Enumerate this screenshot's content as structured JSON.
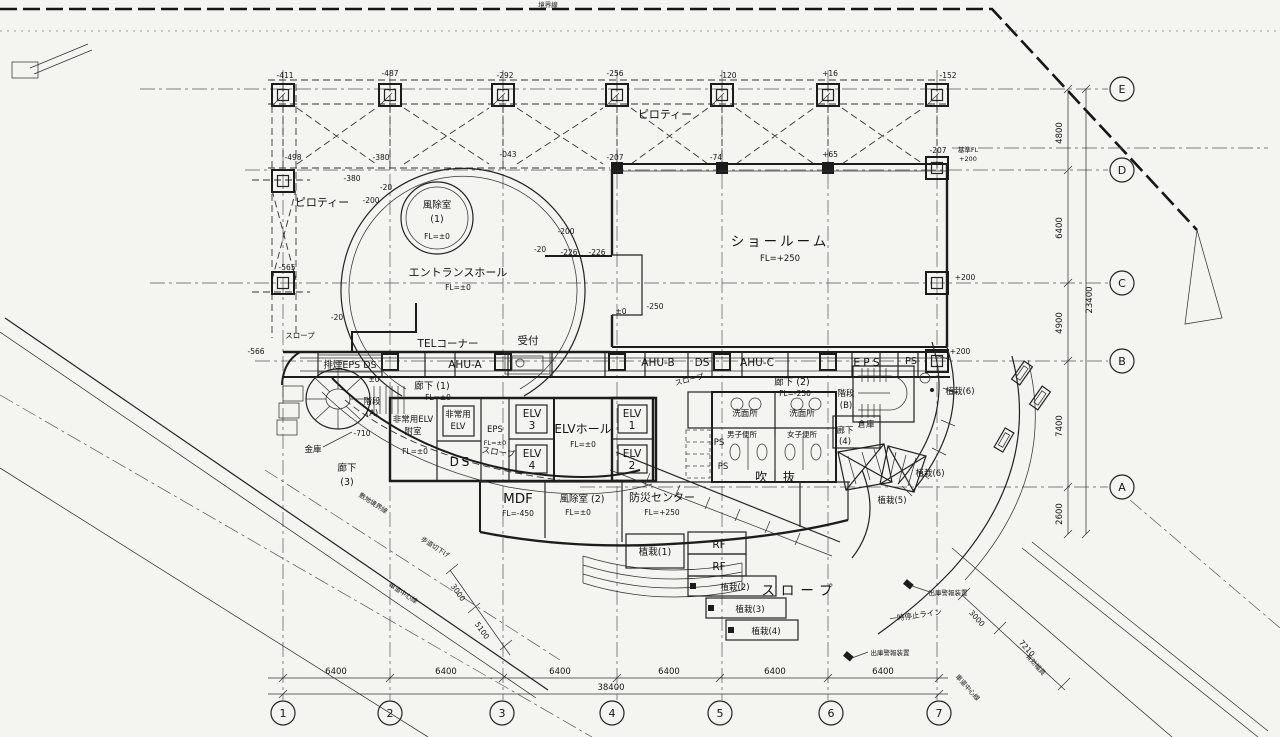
{
  "palette": {
    "paper": "#f4f4f0",
    "ink": "#1c1c1c"
  },
  "grid": {
    "rows": [
      {
        "label": "E"
      },
      {
        "label": "D"
      },
      {
        "label": "C"
      },
      {
        "label": "B"
      },
      {
        "label": "A"
      }
    ],
    "cols": [
      {
        "label": "1"
      },
      {
        "label": "2"
      },
      {
        "label": "3"
      },
      {
        "label": "4"
      },
      {
        "label": "5"
      },
      {
        "label": "6"
      },
      {
        "label": "7"
      }
    ],
    "row_dims": [
      "4800",
      "6400",
      "4900",
      "7400",
      "2600"
    ],
    "row_total": "23400",
    "col_dims": [
      "6400",
      "6400",
      "6400",
      "6400",
      "6400",
      "6400"
    ],
    "col_total": "38400"
  },
  "rooms": {
    "pilotis_left": "ピロティー",
    "pilotis_top": "ピロティー",
    "windbreak1": "風除室",
    "windbreak1_no": "(1)",
    "windbreak1_fl": "FL=±0",
    "entrance_hall": "エントランスホール",
    "entrance_hall_fl": "FL=±0",
    "showroom": "ショールーム",
    "showroom_fl": "FL=+250",
    "tel_corner": "TELコーナー",
    "reception": "受付",
    "ahu_a": "AHU-A",
    "ahu_b": "AHU-B",
    "ahu_c": "AHU-C",
    "ds_band": "DS",
    "eps_band": "EPS",
    "ps_band": "PS",
    "shaft_box": "排煙EPS DS",
    "corridor1": "廊下 (1)",
    "corridor1_fl": "FL=±0",
    "corridor2": "廊下 (2)",
    "corridor2_fl": "FL=-250",
    "corridor3_a": "廊下",
    "corridor3_b": "(3)",
    "corridor4_a": "廊下",
    "corridor4_b": "(4)",
    "stair_a": "階段",
    "stair_a_no": "(A)",
    "stair_b": "階段",
    "stair_b_no": "(B)",
    "em_lobby_1": "非常用ELV",
    "em_lobby_2": "附室",
    "em_lobby_fl": "FL=±0",
    "em_elv_1": "非常用",
    "em_elv_2": "ELV",
    "eps_core": "EPS",
    "eps_core_fl": "FL=±0",
    "ds_core": "DS",
    "elv": "ELV",
    "elv1_no": "1",
    "elv2_no": "2",
    "elv3_no": "3",
    "elv4_no": "4",
    "elv_hall": "ELVホール",
    "elv_hall_fl": "FL=±0",
    "washroom1": "洗面所",
    "washroom2": "洗面所",
    "mens_wc": "男子便所",
    "womens_wc": "女子便所",
    "ps_1": "PS",
    "ps_2": "PS",
    "warehouse": "倉庫",
    "void_space": "吹 抜",
    "mdf": "MDF",
    "mdf_fl": "FL=-450",
    "windbreak2": "風除室 (2)",
    "windbreak2_fl": "FL=±0",
    "disaster": "防災センター",
    "disaster_fl": "FL=+250",
    "safe": "金庫",
    "rf1": "RF",
    "rf2": "RF",
    "planting1": "植栽(1)",
    "planting2": "植栽(2)",
    "planting3": "植栽(3)",
    "planting4": "植栽(4)",
    "planting5": "植栽(5)",
    "planting6a": "植栽(6)",
    "planting6b": "植栽(6)",
    "slope_nw": "スロープ",
    "slope_band": "スロープ",
    "slope_mid": "スロープ",
    "slope_main": "スロープ"
  },
  "offsets": {
    "top": [
      "-411",
      "-487",
      "-292",
      "-256",
      "-120",
      "+16",
      "-152"
    ],
    "mid": [
      "-498",
      "-380",
      "-043",
      "-207",
      "-74",
      "+65",
      "-207"
    ],
    "left": [
      "-565",
      "-566"
    ],
    "circle": [
      "-380",
      "-20",
      "-200",
      "-200",
      "-20",
      "-226",
      "-226",
      "-250",
      "±0",
      "-710",
      "-20",
      "±0"
    ],
    "datum_a": "基準FL",
    "datum_b": "+200",
    "showroom_c": "+200",
    "band_b": "+200"
  },
  "site": {
    "boundary_top": "境界線",
    "site_boundary": "敷地境界線",
    "road_center_sw": "車道中心線",
    "road_center_se": "車道中心線",
    "sidewalk_cut": "歩道切下げ",
    "effective_width": "有効幅員",
    "stop_line": "一時停止ライン",
    "alarm1": "出庫警報装置",
    "alarm2": "出庫警報装置",
    "dim_sw": [
      "3000",
      "5100"
    ],
    "dim_se": [
      "3000",
      "7210"
    ]
  }
}
